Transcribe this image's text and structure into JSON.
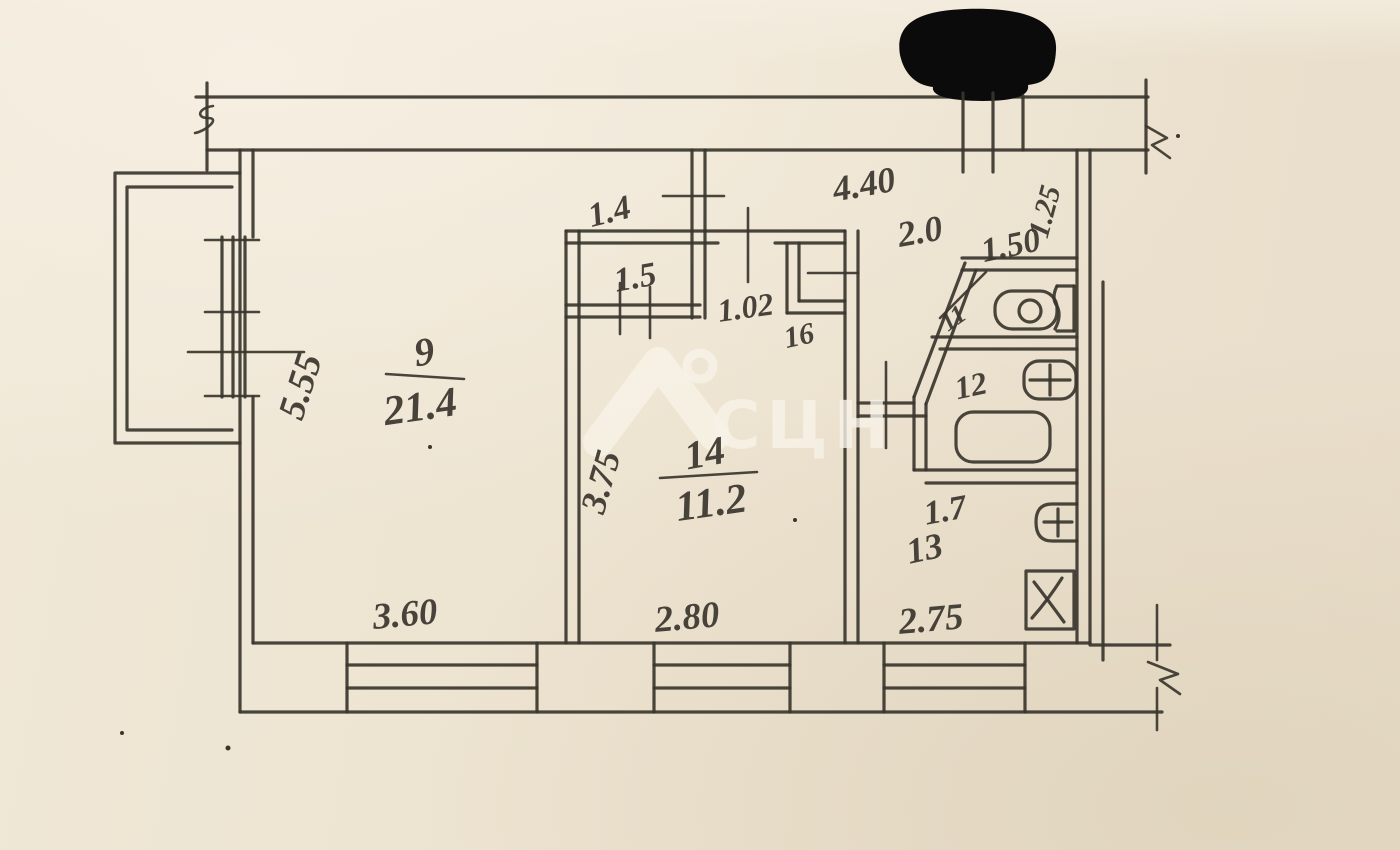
{
  "plan": {
    "rooms": [
      {
        "id": "living",
        "number": "9",
        "area": "21.4"
      },
      {
        "id": "bedroom",
        "number": "14",
        "area": "11.2"
      },
      {
        "id": "wc",
        "number": "11",
        "area": ""
      },
      {
        "id": "bathroom",
        "number": "12",
        "area": ""
      },
      {
        "id": "kitchen",
        "number": "13",
        "area": ""
      },
      {
        "id": "closet",
        "number": "16",
        "area": ""
      }
    ],
    "fixtures": [
      "toilet",
      "washbasin",
      "bathtub",
      "kitchen-sink",
      "stove"
    ]
  },
  "labels": {
    "dim_top_440": "4.40",
    "dim_top_20": "2.0",
    "dim_top_150": "1.50",
    "dim_top_125": "1.25",
    "dim_14": "1.4",
    "dim_15": "1.5",
    "dim_102": "1.02",
    "room_16": "16",
    "room_11": "11",
    "room_12": "12",
    "room_13": "13",
    "dim_17": "1.7",
    "room_9_number": "9",
    "room_9_area": "21.4",
    "dim_555": "5.55",
    "room_14_number": "14",
    "room_14_area": "11.2",
    "dim_375": "3.75",
    "dim_360": "3.60",
    "dim_280": "2.80",
    "dim_275": "2.75"
  },
  "watermark": {
    "text": "СЦН",
    "icon": "house-location-pin-icon"
  },
  "colors": {
    "paper": "#efe6d6",
    "ink": "#3a362e",
    "watermark": "#f8f3e8",
    "redaction": "#0b0b0b"
  }
}
